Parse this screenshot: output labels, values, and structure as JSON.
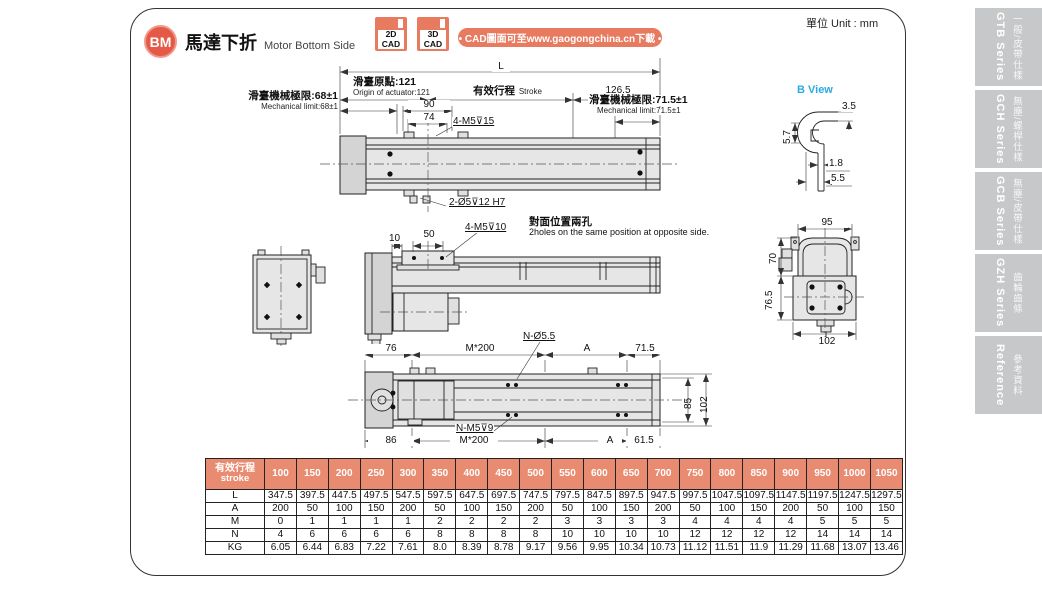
{
  "page": {
    "badge": "BM",
    "title_cn": "馬達下折",
    "title_en": "Motor Bottom Side",
    "unit": "單位 Unit : mm",
    "cad_banner": "• CAD圖面可至www.gaogongchina.cn下載 •",
    "cad_icons": [
      {
        "line1": "2D",
        "line2": "CAD"
      },
      {
        "line1": "3D",
        "line2": "CAD"
      }
    ]
  },
  "sidebar": {
    "tabs": [
      {
        "series": "GTB Series",
        "label": "一般/皮帶仕樣"
      },
      {
        "series": "GCH Series",
        "label": "無塵/螺桿仕樣"
      },
      {
        "series": "GCB Series",
        "label": "無塵/皮帶仕樣"
      },
      {
        "series": "GZH Series",
        "label": "齒輪齒條"
      },
      {
        "series": "Reference",
        "label": "參考資料"
      }
    ]
  },
  "drawings": {
    "top": {
      "L": "L",
      "origin_cn": "滑臺原點:121",
      "origin_en": "Origin of actuator:121",
      "stroke_cn": "有效行程",
      "stroke_en": "Stroke",
      "d126": "126.5",
      "mech_left_cn": "滑臺機械極限:68±1",
      "mech_left_en": "Mechanical limit:68±1",
      "d90": "90",
      "d74": "74",
      "m5_15": "4-M5⊽15",
      "mech_right_cn": "滑臺機械極限:71.5±1",
      "mech_right_en": "Mechanical limit:71.5±1",
      "o5": "2-Ø5⊽12 H7"
    },
    "middle": {
      "d10": "10",
      "d50": "50",
      "m5_10": "4-M5⊽10",
      "holes_cn": "對面位置兩孔",
      "holes_en": "2holes on the same position at opposite side."
    },
    "bottom": {
      "n_o55": "N-Ø5.5",
      "d76": "76",
      "m200_top": "M*200",
      "a_top": "A",
      "d715": "71.5",
      "d85": "85",
      "d102": "102",
      "d86": "86",
      "n_m5": "N-M5⊽9",
      "m200_bot": "M*200",
      "a_bot": "A",
      "d615": "61.5"
    },
    "b_view": {
      "title": "B View",
      "d35": "3.5",
      "d57": "5.7",
      "d18": "1.8",
      "d55": "5.5"
    },
    "end_view": {
      "d95": "95",
      "d70": "70",
      "d765": "76.5",
      "d102": "102"
    }
  },
  "table": {
    "header_cn": "有效行程",
    "header_en": "stroke",
    "columns": [
      "100",
      "150",
      "200",
      "250",
      "300",
      "350",
      "400",
      "450",
      "500",
      "550",
      "600",
      "650",
      "700",
      "750",
      "800",
      "850",
      "900",
      "950",
      "1000",
      "1050"
    ],
    "rows": [
      {
        "label": "L",
        "values": [
          "347.5",
          "397.5",
          "447.5",
          "497.5",
          "547.5",
          "597.5",
          "647.5",
          "697.5",
          "747.5",
          "797.5",
          "847.5",
          "897.5",
          "947.5",
          "997.5",
          "1047.5",
          "1097.5",
          "1147.5",
          "1197.5",
          "1247.5",
          "1297.5"
        ]
      },
      {
        "label": "A",
        "values": [
          "200",
          "50",
          "100",
          "150",
          "200",
          "50",
          "100",
          "150",
          "200",
          "50",
          "100",
          "150",
          "200",
          "50",
          "100",
          "150",
          "200",
          "50",
          "100",
          "150"
        ]
      },
      {
        "label": "M",
        "values": [
          "0",
          "1",
          "1",
          "1",
          "1",
          "2",
          "2",
          "2",
          "2",
          "3",
          "3",
          "3",
          "3",
          "4",
          "4",
          "4",
          "4",
          "5",
          "5",
          "5"
        ]
      },
      {
        "label": "N",
        "values": [
          "4",
          "6",
          "6",
          "6",
          "6",
          "8",
          "8",
          "8",
          "8",
          "10",
          "10",
          "10",
          "10",
          "12",
          "12",
          "12",
          "12",
          "14",
          "14",
          "14"
        ]
      },
      {
        "label": "KG",
        "values": [
          "6.05",
          "6.44",
          "6.83",
          "7.22",
          "7.61",
          "8.0",
          "8.39",
          "8.78",
          "9.17",
          "9.56",
          "9.95",
          "10.34",
          "10.73",
          "11.12",
          "11.51",
          "11.9",
          "11.29",
          "11.68",
          "13.07",
          "13.46"
        ]
      }
    ]
  },
  "colors": {
    "accent": "#e45a47",
    "salmon": "#e87a60",
    "table_header": "#e98b70",
    "sidebar_gray": "#c7c8c9",
    "blue": "#29abe2"
  }
}
